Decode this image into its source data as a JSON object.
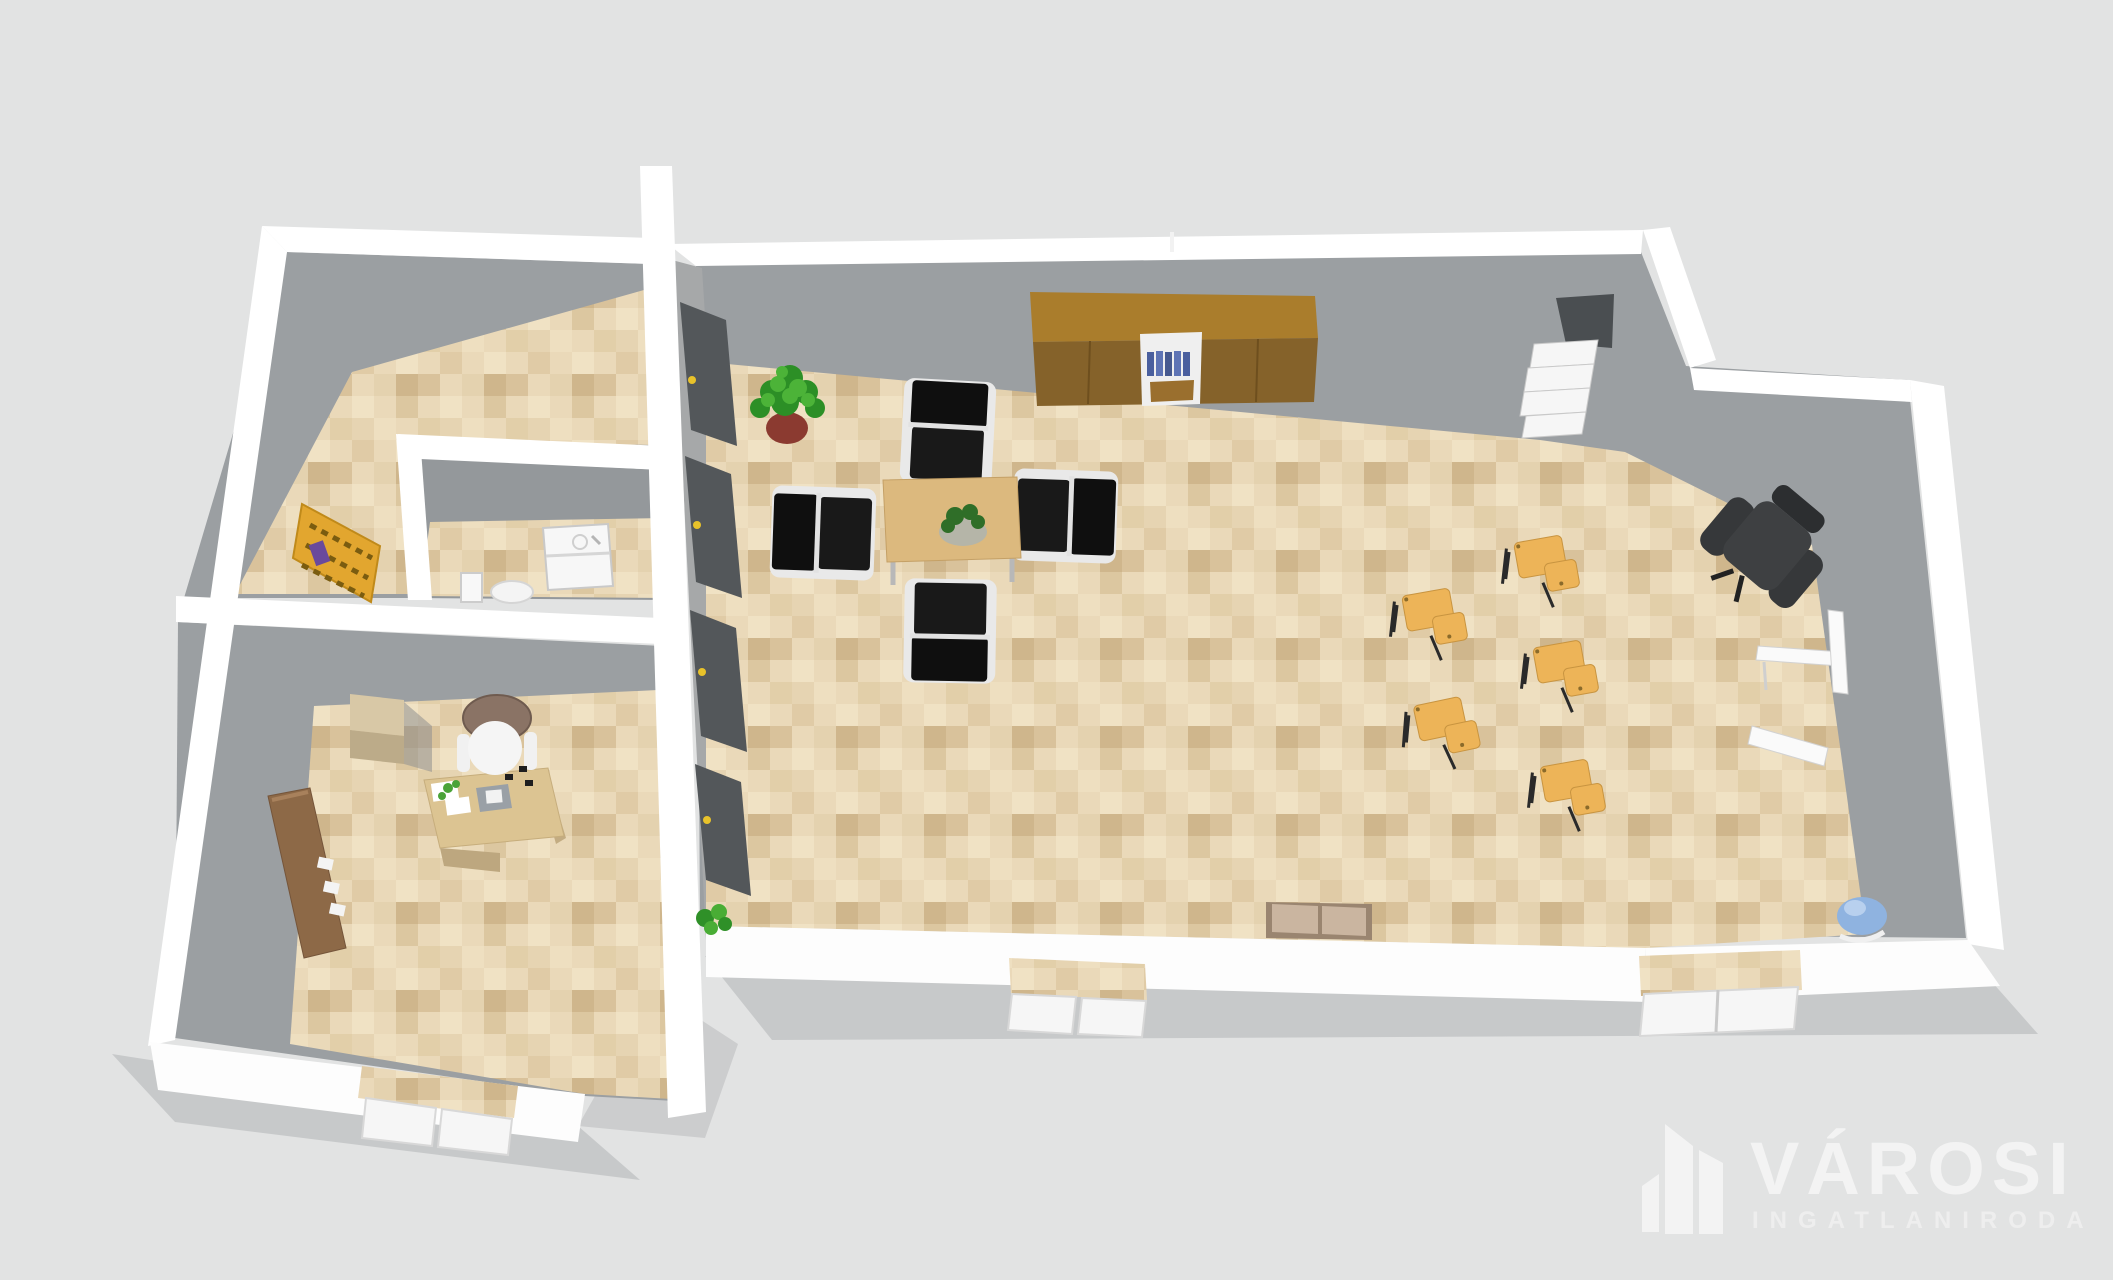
{
  "watermark": {
    "brand": "VÁROSI",
    "subtitle": "INGATLANIRODA",
    "icon": "city-buildings-icon",
    "text_color": "#f3f3f3"
  },
  "scene": {
    "type": "3d-floor-plan-render",
    "view": "top-down oblique perspective",
    "background_color": "#e2e3e3",
    "palette": {
      "wall_white": "#ffffff",
      "wall_inner_gray": "#9b9fa2",
      "wall_shadow_gray": "#c7c9ca",
      "floor_tile_base": "#ead9b9",
      "floor_tile_dark": "#d9c29b",
      "cabinet_brown_top": "#aa7d2c",
      "cabinet_brown_front": "#85622a",
      "table_wood": "#dcb97e",
      "chair_black": "#111111",
      "chair_orange": "#edb458",
      "shelf_yellow": "#e2a62f",
      "plant_green": "#3e9130",
      "plant_pot_red": "#8b3a30",
      "sideboard_brown": "#8d6947",
      "accent_blue_books": "#4a5f9e",
      "beanbag_blue": "#8fb3e0"
    },
    "rooms": [
      {
        "name": "storage-room",
        "position": "top-left",
        "furniture": [
          "yellow-bookshelf"
        ]
      },
      {
        "name": "washroom",
        "position": "middle-left",
        "furniture": [
          "sink-vanity",
          "toilet",
          "small-wall-cabinet"
        ]
      },
      {
        "name": "office",
        "position": "bottom-left",
        "furniture": [
          "office-desk",
          "office-chair",
          "storage-cube",
          "brown-sideboard",
          "desk-papers",
          "desk-laptop"
        ]
      },
      {
        "name": "main-open-space",
        "position": "center",
        "furniture": [
          "brown-wardrobe-with-bookshelf",
          "meeting-table",
          "table-plant",
          "black-chair-north",
          "black-chair-west",
          "black-chair-east",
          "black-chair-south",
          "floor-plant-large",
          "floor-plant-small",
          "tall-gray-cabinets",
          "corner-spiral-shelf",
          "sofa"
        ]
      },
      {
        "name": "seminar-area",
        "position": "right",
        "furniture": [
          "orange-tablet-chair-1",
          "orange-tablet-chair-2",
          "orange-tablet-chair-3",
          "orange-tablet-chair-4",
          "orange-tablet-chair-5",
          "executive-chair",
          "white-wall-desk",
          "blue-beanbag"
        ]
      }
    ],
    "doors": [
      {
        "name": "entry-door-office",
        "wall": "south",
        "type": "double"
      },
      {
        "name": "entry-door-main",
        "wall": "south",
        "type": "double"
      },
      {
        "name": "entry-door-seminar",
        "wall": "south",
        "type": "double"
      }
    ]
  }
}
